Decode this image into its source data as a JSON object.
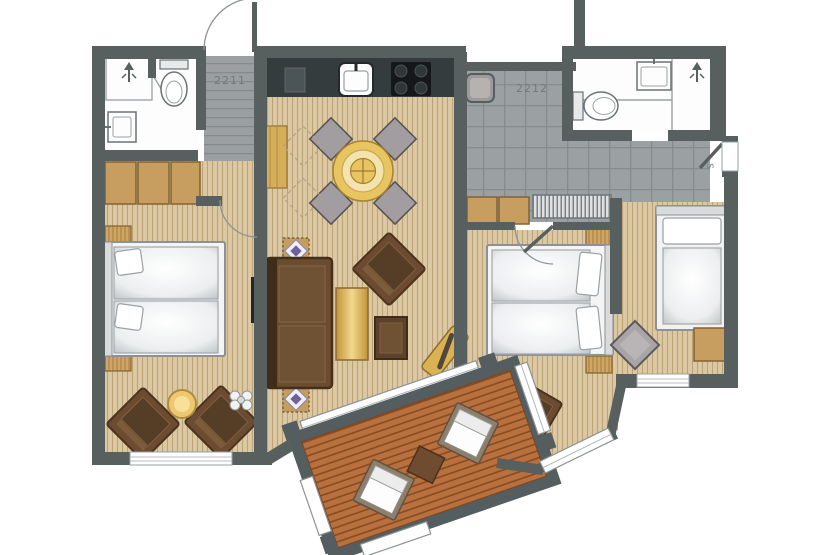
{
  "plan": {
    "type": "apartment-floor-plan",
    "labels": {
      "unit_left": "2211",
      "unit_right": "2212",
      "side_marker": "S"
    },
    "colors": {
      "wall": "#57605f",
      "wood_floor": "#dcc8a2",
      "tile_floor": "#9ba1a3",
      "deck_planks": "#b7703e",
      "kitchen_counter": "#343c3e",
      "furniture_tan": "#c79e60",
      "furniture_brown": "#6d4b31",
      "accent_gold": "#e8c560",
      "fixture_white": "#fdfdfd"
    },
    "icons": [
      {
        "name": "shower-icon",
        "meaning": "shower head, up arrow"
      },
      {
        "name": "toilet-icon",
        "meaning": "toilet bowl"
      },
      {
        "name": "sink-icon",
        "meaning": "wash basin"
      },
      {
        "name": "stove-icon",
        "meaning": "4-burner cooktop"
      },
      {
        "name": "door-swing-icon",
        "meaning": "door swing arc"
      }
    ]
  }
}
